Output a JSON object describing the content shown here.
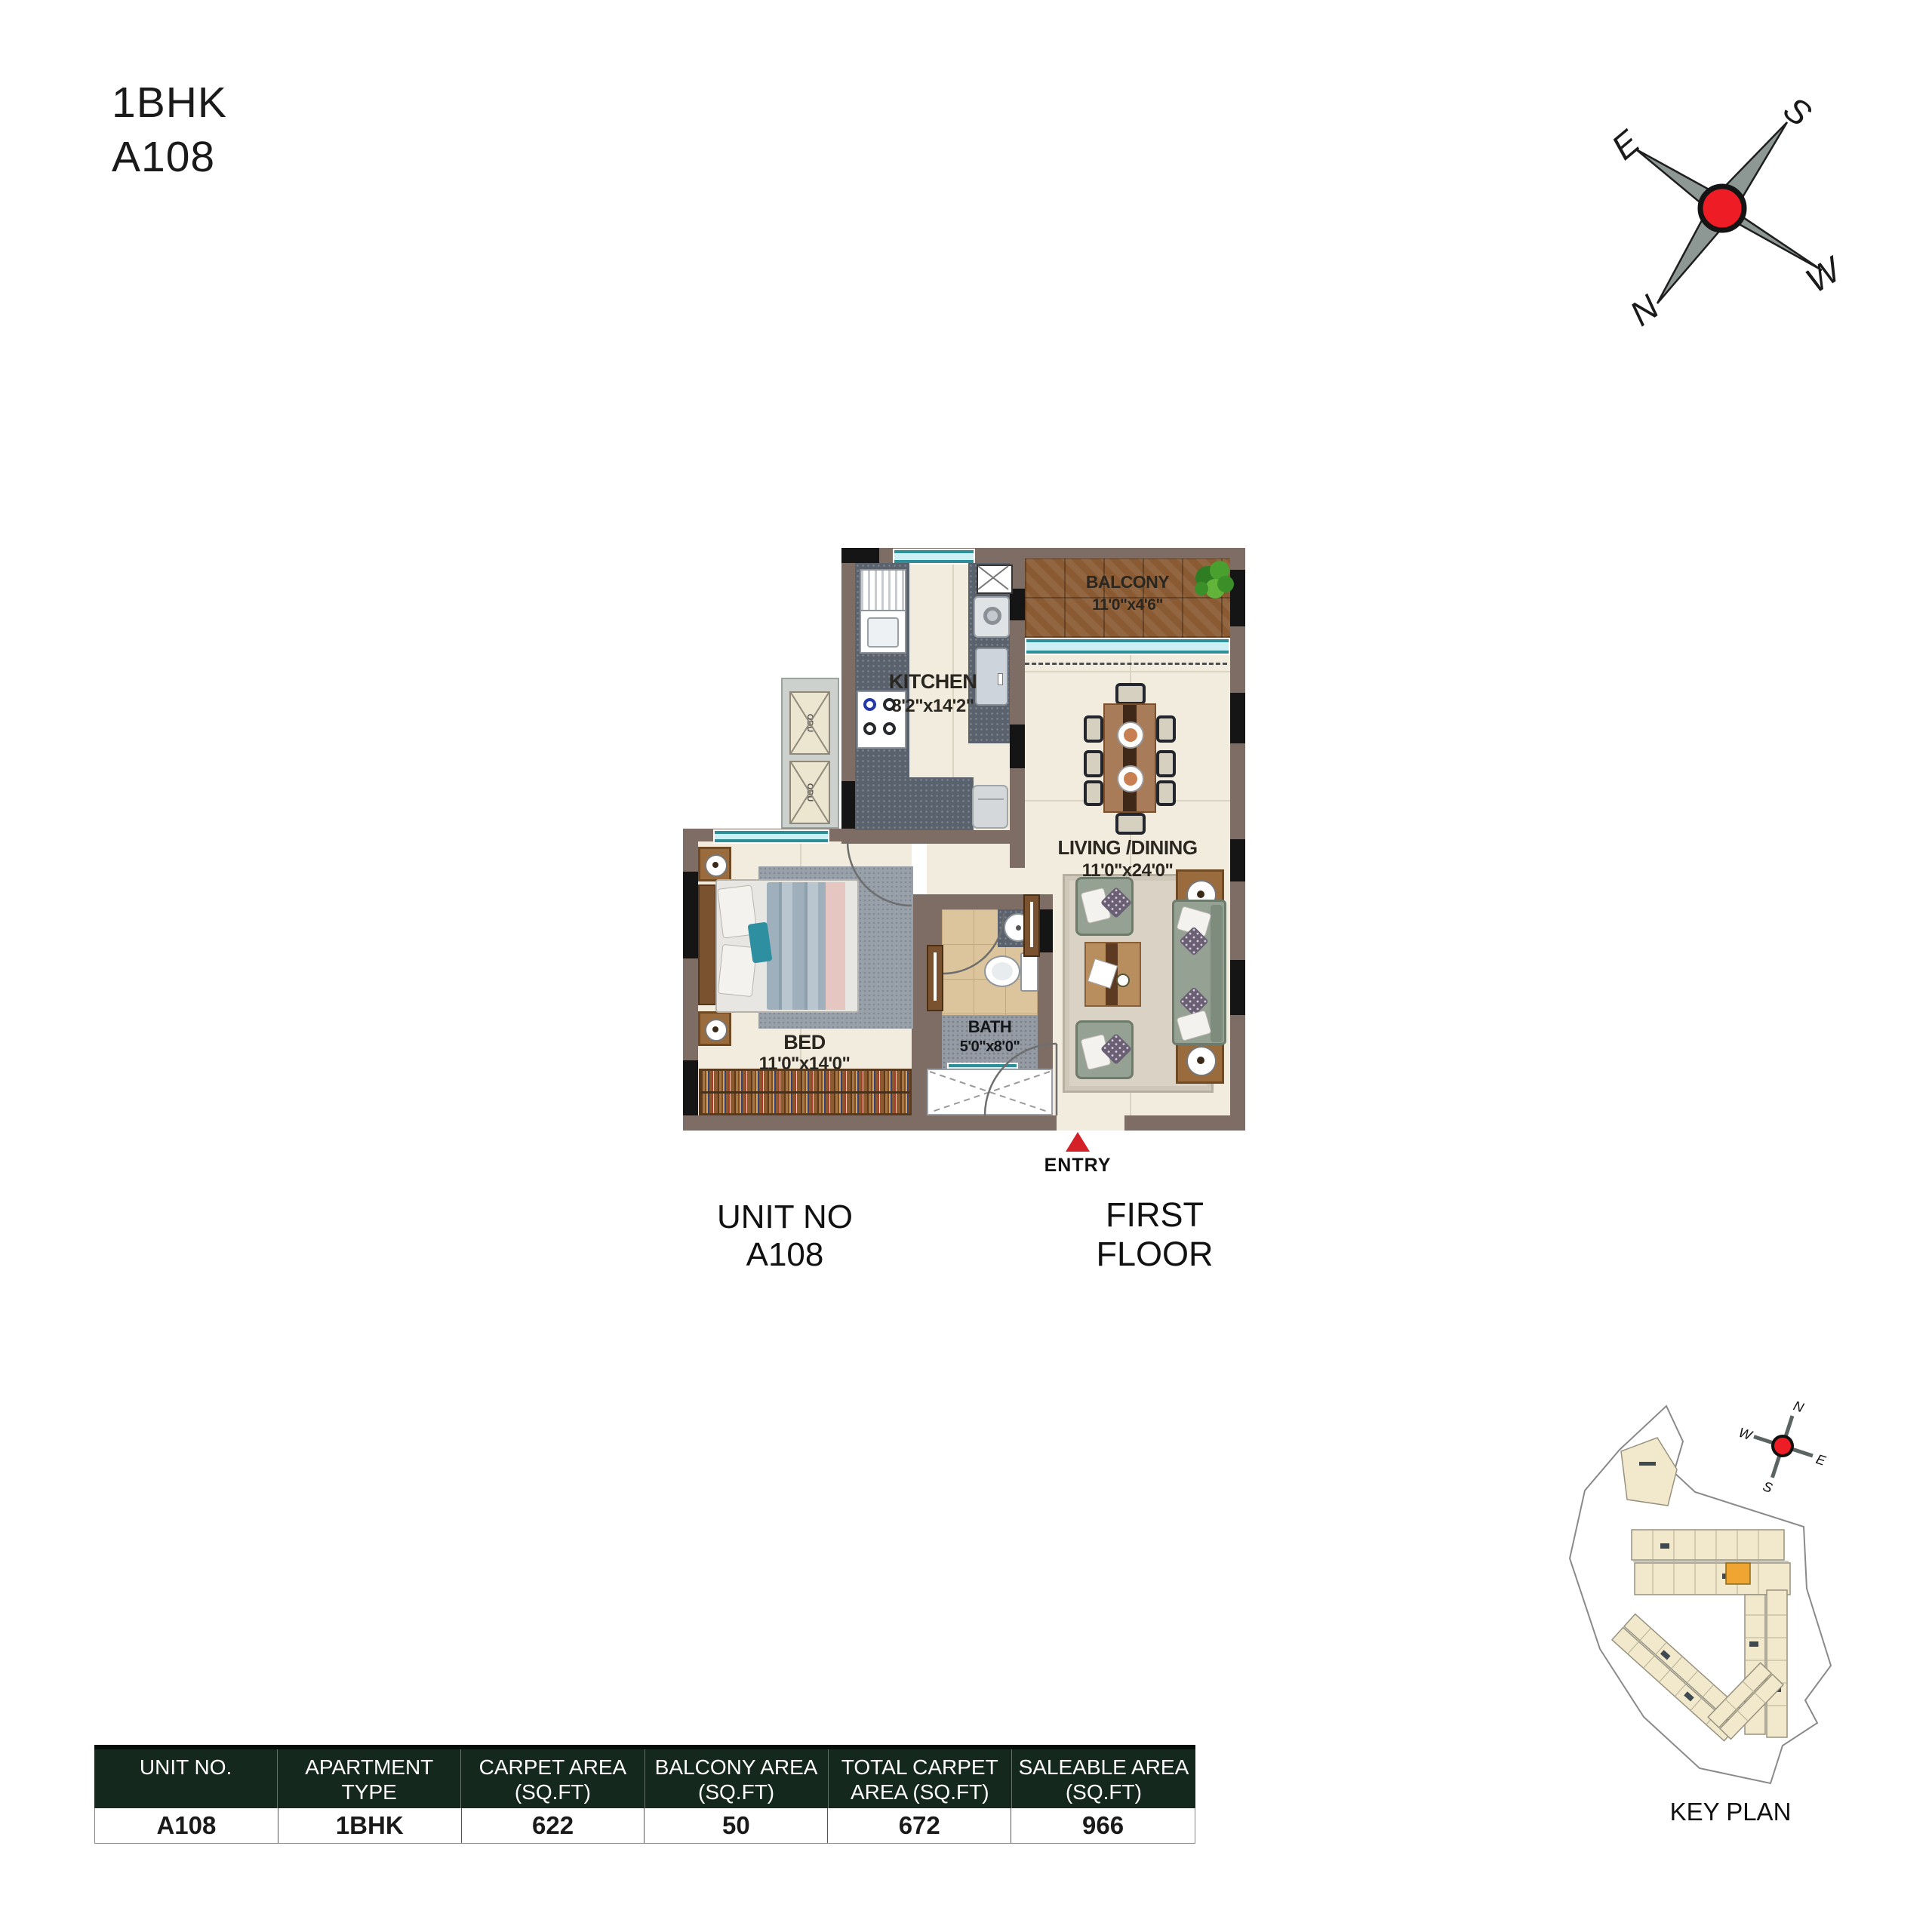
{
  "title": {
    "line1": "1BHK",
    "line2": "A108"
  },
  "compass": {
    "n": "N",
    "s": "S",
    "e": "E",
    "w": "W"
  },
  "plan": {
    "rooms": {
      "balcony": {
        "name": "BALCONY",
        "dims": "11'0\"x4'6\""
      },
      "kitchen": {
        "name": "KITCHEN",
        "dims": "8'2\"x14'2\""
      },
      "living": {
        "name": "LIVING /DINING",
        "dims": "11'0\"x24'0\""
      },
      "bed": {
        "name": "BED",
        "dims": "11'0\"x14'0\""
      },
      "bath": {
        "name": "BATH",
        "dims": "5'0\"x8'0\""
      }
    },
    "entry_label": "ENTRY",
    "odu_label": "ODU",
    "unit_caption": "UNIT NO A108",
    "floor_caption": "FIRST FLOOR"
  },
  "key_plan": {
    "caption": "KEY PLAN"
  },
  "area_table": {
    "headers": [
      {
        "line1": "UNIT NO.",
        "line2": ""
      },
      {
        "line1": "APARTMENT",
        "line2": "TYPE"
      },
      {
        "line1": "CARPET AREA",
        "line2": "(SQ.FT)"
      },
      {
        "line1": "BALCONY AREA",
        "line2": "(SQ.FT)"
      },
      {
        "line1": "TOTAL CARPET",
        "line2": "AREA (SQ.FT)"
      },
      {
        "line1": "SALEABLE AREA",
        "line2": "(SQ.FT)"
      }
    ],
    "values": [
      "A108",
      "1BHK",
      "622",
      "50",
      "672",
      "966"
    ]
  },
  "colors": {
    "entry_red": "#d42027",
    "compass_red": "#ee1c25",
    "table_header_green": "#15281d",
    "keyplan_highlight": "#f0a431"
  }
}
